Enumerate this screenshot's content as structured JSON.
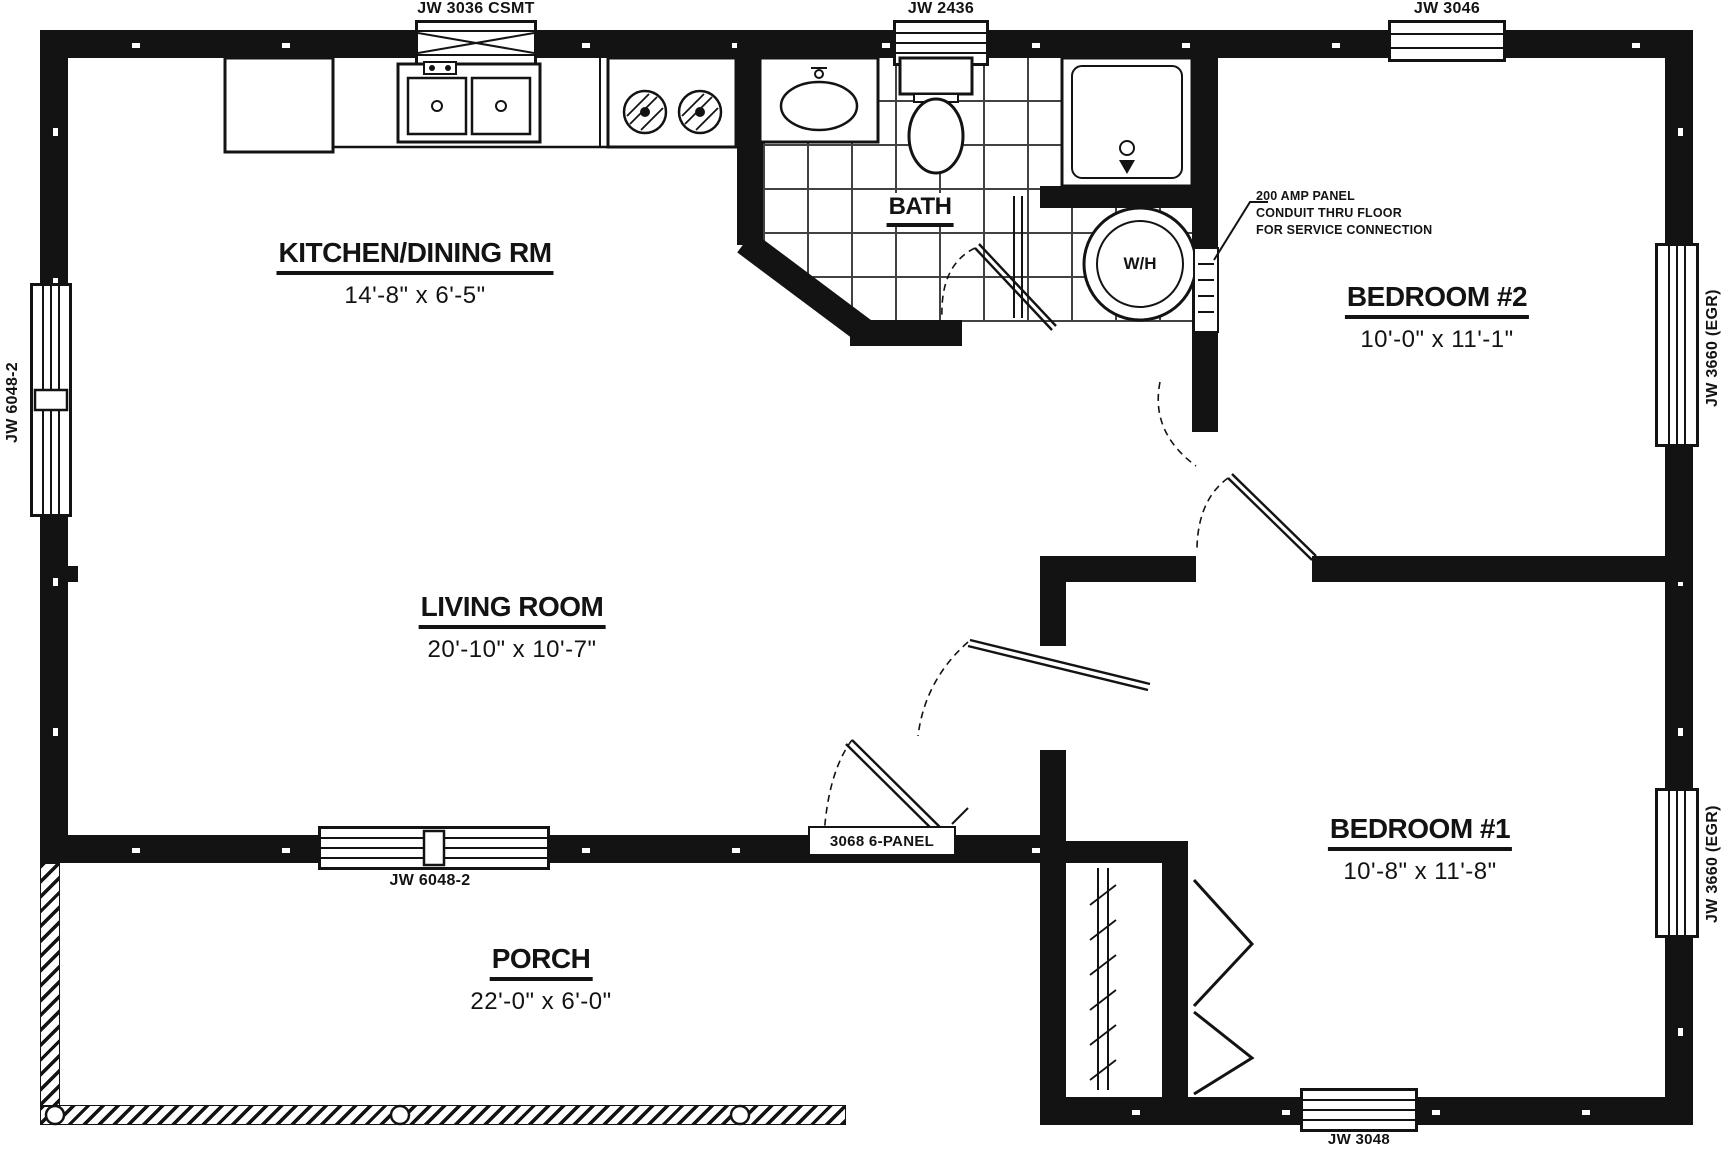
{
  "colors": {
    "ink": "#131313",
    "paper": "#ffffff"
  },
  "rooms": {
    "kitchen": {
      "name": "KITCHEN/DINING RM",
      "dims": "14'-8\" x 6'-5\""
    },
    "bath": {
      "name": "BATH",
      "dims": ""
    },
    "bedroom2": {
      "name": "BEDROOM #2",
      "dims": "10'-0\" x 11'-1\""
    },
    "living": {
      "name": "LIVING ROOM",
      "dims": "20'-10\" x 10'-7\""
    },
    "bedroom1": {
      "name": "BEDROOM #1",
      "dims": "10'-8\" x 11'-8\""
    },
    "porch": {
      "name": "PORCH",
      "dims": "22'-0\" x 6'-0\""
    }
  },
  "windows": {
    "top_left": "JW 3036 CSMT",
    "top_mid": "JW 2436",
    "top_right": "JW 3046",
    "left": "JW 6048-2",
    "right_upper": "JW 3660 (EGR)",
    "right_lower": "JW 3660 (EGR)",
    "living_bottom": "JW 6048-2",
    "bottom_right": "JW 3048"
  },
  "doors": {
    "porch_door": "3068 6-PANEL"
  },
  "annotation": {
    "line1": "200 AMP PANEL",
    "line2": "CONDUIT THRU FLOOR",
    "line3": "FOR SERVICE CONNECTION"
  },
  "fixtures": {
    "water_heater": "W/H"
  }
}
